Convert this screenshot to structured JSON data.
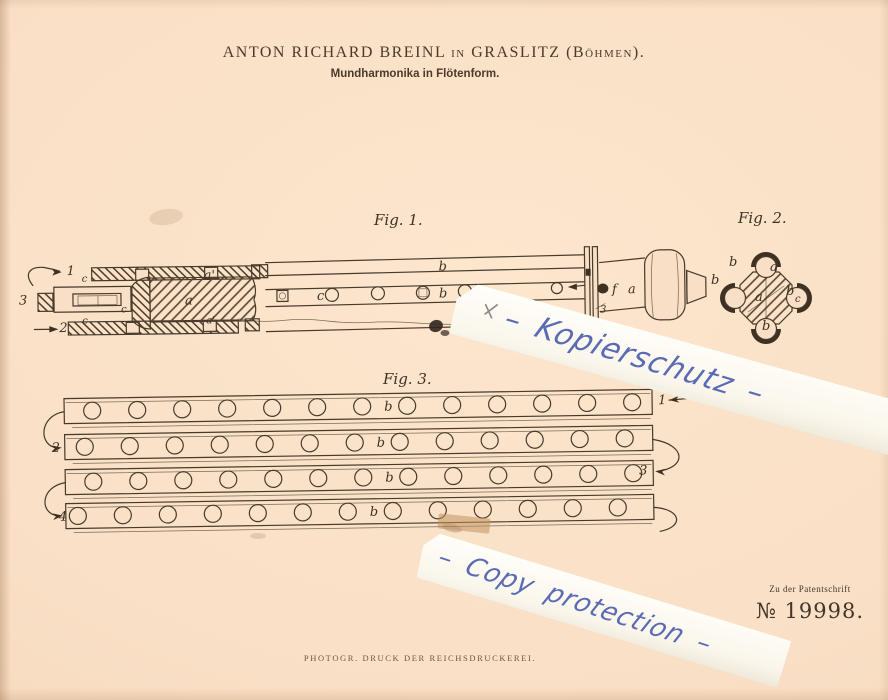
{
  "header": {
    "title": "ANTON RICHARD BREINL in GRASLITZ (Böhmen).",
    "subtitle": "Mundharmonika in Flötenform."
  },
  "figures": {
    "fig1": {
      "caption": "Fig. 1.",
      "labels": [
        {
          "t": "1",
          "x": 67,
          "y": 272
        },
        {
          "t": "3",
          "x": 19,
          "y": 301
        },
        {
          "t": "2",
          "x": 59,
          "y": 329
        },
        {
          "t": "c",
          "x": 121,
          "y": 310,
          "fs": 1
        },
        {
          "t": "c",
          "x": 82,
          "y": 279,
          "fs": 1
        },
        {
          "t": "c",
          "x": 82,
          "y": 321,
          "fs": 1
        },
        {
          "t": "a",
          "x": 185,
          "y": 303
        },
        {
          "t": "a'",
          "x": 204,
          "y": 278
        },
        {
          "t": "a'",
          "x": 206,
          "y": 322,
          "fs": 1
        },
        {
          "t": "c",
          "x": 317,
          "y": 300
        },
        {
          "t": "b",
          "x": 439,
          "y": 272
        },
        {
          "t": "b",
          "x": 439,
          "y": 299
        },
        {
          "t": "f",
          "x": 612,
          "y": 297
        },
        {
          "t": "a",
          "x": 628,
          "y": 297
        },
        {
          "t": "3",
          "x": 600,
          "y": 316,
          "fs": 1
        }
      ]
    },
    "fig2": {
      "caption": "Fig. 2.",
      "labels": [
        {
          "t": "b",
          "x": 729,
          "y": 266
        },
        {
          "t": "a'",
          "x": 770,
          "y": 271
        },
        {
          "t": "b",
          "x": 711,
          "y": 284
        },
        {
          "t": "b",
          "x": 786,
          "y": 295
        },
        {
          "t": "c",
          "x": 795,
          "y": 302,
          "fs": 1
        },
        {
          "t": "a",
          "x": 755,
          "y": 301
        },
        {
          "t": "b",
          "x": 762,
          "y": 330
        }
      ]
    },
    "fig3": {
      "caption": "Fig. 3.",
      "hole_label": "b",
      "rows": [
        {
          "num": "1"
        },
        {
          "num": "2"
        },
        {
          "num": "3"
        },
        {
          "num": "4"
        }
      ]
    }
  },
  "watermarks": {
    "strip1": "– Kopierschutz –",
    "strip2": "– Copy  protection –",
    "ink_color": "#4c5fae"
  },
  "patent": {
    "ref_label": "Zu der Patentschrift",
    "number": "№ 19998."
  },
  "footer": {
    "imprint": "PHOTOGR. DRUCK DER REICHSDRUCKEREI."
  },
  "colors": {
    "paper": "#f9dfc5",
    "ink": "#3e3122",
    "strip_white": "#fbf9f2"
  }
}
